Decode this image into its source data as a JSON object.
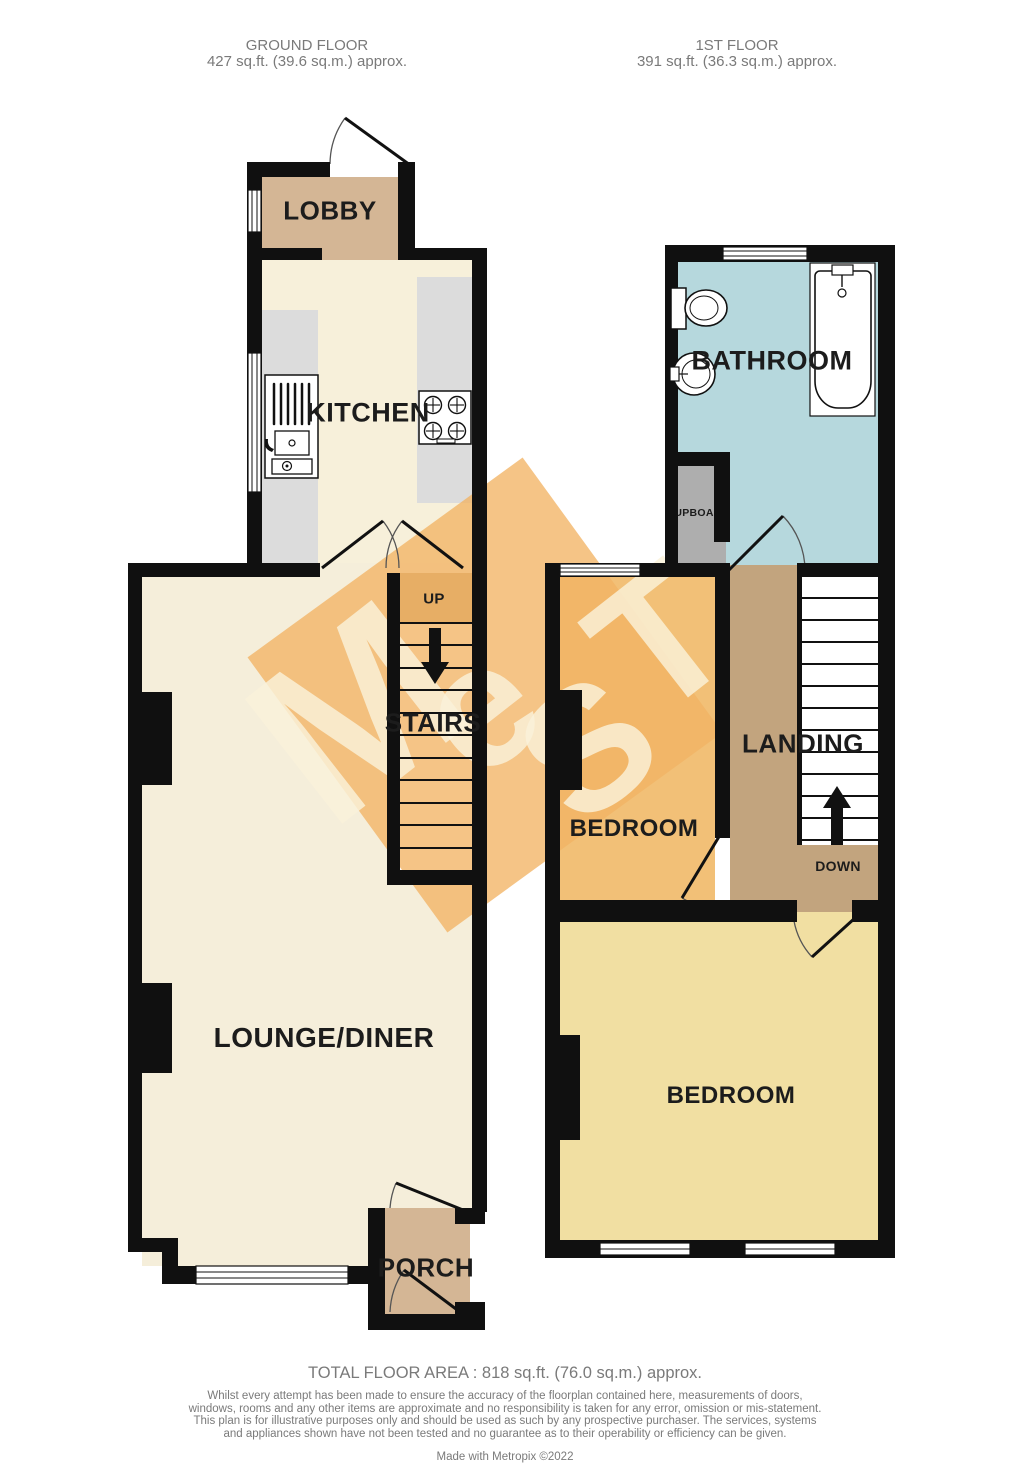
{
  "ground_floor": {
    "title": "GROUND FLOOR",
    "area": "427 sq.ft. (39.6 sq.m.) approx.",
    "rooms": {
      "lobby": "LOBBY",
      "kitchen": "KITCHEN",
      "stairs": "STAIRS",
      "stairs_direction": "UP",
      "lounge": "LOUNGE/DINER",
      "porch": "PORCH"
    }
  },
  "first_floor": {
    "title": "1ST FLOOR",
    "area": "391 sq.ft. (36.3 sq.m.) approx.",
    "rooms": {
      "bathroom": "BATHROOM",
      "cupboard": "CUPBOARD",
      "landing": "LANDING",
      "bedroom_front": "BEDROOM",
      "bedroom_back": "BEDROOM",
      "stairs_direction": "DOWN"
    }
  },
  "footer": {
    "total_area": "TOTAL FLOOR AREA : 818 sq.ft. (76.0 sq.m.) approx.",
    "disclaimer": "Whilst every attempt has been made to ensure the accuracy of the floorplan contained here, measurements of doors, windows, rooms and any other items are approximate and no responsibility is taken for any error, omission or mis-statement. This plan is for illustrative purposes only and should be used as such by any prospective purchaser. The services, systems and appliances shown have not been tested and no guarantee as to their operability or efficiency can be given.",
    "credit": "Made with Metropix ©2022"
  },
  "watermark": {
    "letters": [
      "M",
      "e",
      "S",
      "T"
    ]
  },
  "colors": {
    "wall": "#101010",
    "lobby_porch_tan": "#d4b695",
    "kitchen_cream": "#f7f0da",
    "lounge_cream": "#f5eeda",
    "counter_gray": "#dcdcdc",
    "stair_top_tan": "#bf9a6b",
    "bathroom_blue": "#b6d8dd",
    "cupboard_gray": "#aeaeae",
    "landing_tan": "#c2a47e",
    "bedroom_orange": "#f2c077",
    "bedroom_yellow": "#f1dfa2",
    "watermark_orange": "#f2b364",
    "text_gray": "#7a7a7a",
    "label_black": "#1c1c1c"
  }
}
